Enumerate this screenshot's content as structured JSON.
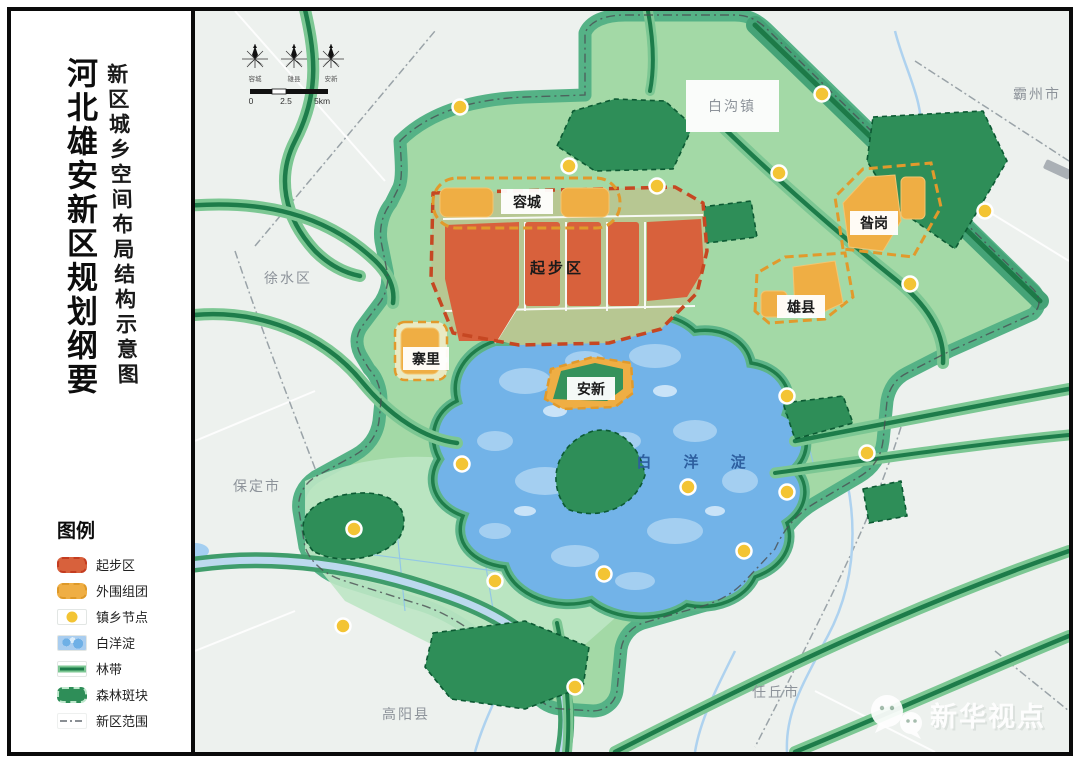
{
  "panel": {
    "title": "河北雄安新区规划纲要",
    "subtitle": "新区城乡空间布局结构示意图",
    "legend": {
      "title": "图例",
      "items": [
        {
          "label": "起步区"
        },
        {
          "label": "外围组团"
        },
        {
          "label": "镇乡节点"
        },
        {
          "label": "白洋淀"
        },
        {
          "label": "林带"
        },
        {
          "label": "森林斑块"
        },
        {
          "label": "新区范围"
        }
      ]
    }
  },
  "map": {
    "compass_labels": [
      "容城",
      "雄县",
      "安新"
    ],
    "scale": {
      "start": "0",
      "mid": "2.5",
      "end": "5km"
    },
    "district_labels": {
      "rongcheng": "容城",
      "startarea": "起步区",
      "zangang": "昝岗",
      "xiongxian": "雄县",
      "zhaili": "寨里",
      "anxin": "安新"
    },
    "city_labels": {
      "baigouzhen": "白沟镇",
      "bazhoushi": "霸州市",
      "xushuiqu": "徐水区",
      "baodingshi": "保定市",
      "gaoyangxian": "高阳县",
      "renqiushi": "任丘市"
    },
    "lake_label": "白 洋 淀",
    "watermark": "新华视点",
    "colors": {
      "start_area_red": "#d8613c",
      "cluster_orange": "#efae44",
      "node_yellow": "#f3c434",
      "lake_blue": "#72b3e8",
      "forest_green": "#2e8e58",
      "belt_green": "#1d7c4a",
      "area_green": "#a3d9a6"
    }
  }
}
